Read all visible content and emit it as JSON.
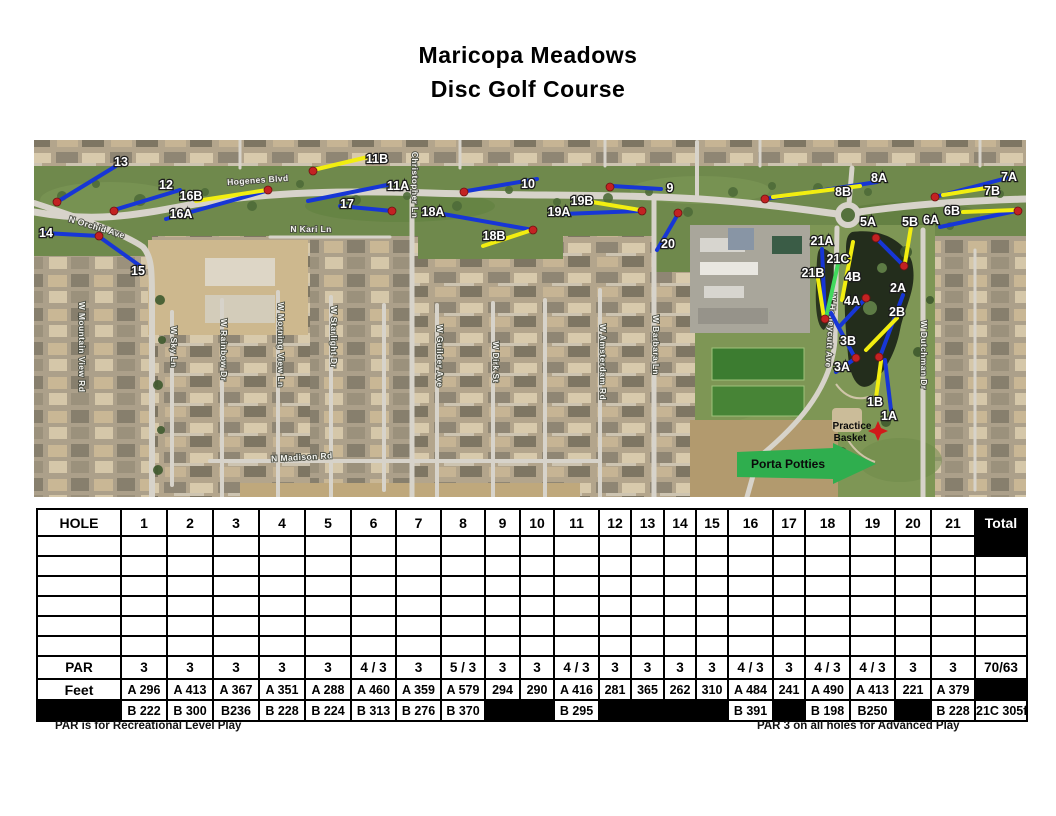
{
  "title": {
    "line1": "Maricopa Meadows",
    "line2": "Disc Golf Course"
  },
  "map": {
    "colors": {
      "tee_a": "#1736d6",
      "tee_b": "#f2ee10",
      "tee_c": "#41d95c",
      "basket": "#c32222",
      "hole_label": "#ffffff",
      "street_label": "#f4f4f0"
    },
    "streets": [
      {
        "label": "Hogenes Blvd",
        "x": 258,
        "y": 183,
        "rot": -4
      },
      {
        "label": "N Orchid Ave",
        "x": 96,
        "y": 230,
        "rot": 17
      },
      {
        "label": "N Kari Ln",
        "x": 311,
        "y": 232,
        "rot": 0
      },
      {
        "label": "Christopher Ln",
        "x": 412,
        "y": 185,
        "rot": 90
      },
      {
        "label": "W Mountain View Rd",
        "x": 79,
        "y": 347,
        "rot": 90
      },
      {
        "label": "W Sky Ln",
        "x": 171,
        "y": 347,
        "rot": 90
      },
      {
        "label": "W Rainbow Dr",
        "x": 221,
        "y": 350,
        "rot": 90
      },
      {
        "label": "W Morning View Ln",
        "x": 278,
        "y": 345,
        "rot": 90
      },
      {
        "label": "W Starlight Dr",
        "x": 331,
        "y": 337,
        "rot": 90
      },
      {
        "label": "W Guilder Ave",
        "x": 437,
        "y": 356,
        "rot": 90
      },
      {
        "label": "W Dirk St",
        "x": 493,
        "y": 362,
        "rot": 90
      },
      {
        "label": "W Amsterdam Rd",
        "x": 600,
        "y": 362,
        "rot": 90
      },
      {
        "label": "W Barbara Ln",
        "x": 653,
        "y": 345,
        "rot": 90
      },
      {
        "label": "N Madison Rd",
        "x": 302,
        "y": 460,
        "rot": -3
      },
      {
        "label": "W Honeycutt Ave",
        "x": 828,
        "y": 330,
        "rot": 94
      },
      {
        "label": "W Dutchman Dr",
        "x": 921,
        "y": 355,
        "rot": 90
      }
    ],
    "hole_markers": [
      {
        "label": "14",
        "x": 46,
        "y": 233
      },
      {
        "label": "13",
        "x": 121,
        "y": 162
      },
      {
        "label": "12",
        "x": 166,
        "y": 185
      },
      {
        "label": "16B",
        "x": 191,
        "y": 196
      },
      {
        "label": "16A",
        "x": 181,
        "y": 214
      },
      {
        "label": "15",
        "x": 138,
        "y": 271
      },
      {
        "label": "11B",
        "x": 377,
        "y": 159
      },
      {
        "label": "11A",
        "x": 398,
        "y": 186
      },
      {
        "label": "17",
        "x": 347,
        "y": 204
      },
      {
        "label": "18A",
        "x": 433,
        "y": 212
      },
      {
        "label": "18B",
        "x": 494,
        "y": 236
      },
      {
        "label": "10",
        "x": 528,
        "y": 184
      },
      {
        "label": "19A",
        "x": 559,
        "y": 212
      },
      {
        "label": "19B",
        "x": 582,
        "y": 201
      },
      {
        "label": "9",
        "x": 670,
        "y": 188
      },
      {
        "label": "20",
        "x": 668,
        "y": 244
      },
      {
        "label": "8A",
        "x": 879,
        "y": 178
      },
      {
        "label": "8B",
        "x": 843,
        "y": 192
      },
      {
        "label": "7A",
        "x": 1009,
        "y": 177
      },
      {
        "label": "7B",
        "x": 992,
        "y": 191
      },
      {
        "label": "6B",
        "x": 952,
        "y": 211
      },
      {
        "label": "6A",
        "x": 931,
        "y": 220
      },
      {
        "label": "5A",
        "x": 868,
        "y": 222
      },
      {
        "label": "5B",
        "x": 910,
        "y": 222
      },
      {
        "label": "21A",
        "x": 822,
        "y": 241
      },
      {
        "label": "21C",
        "x": 838,
        "y": 259
      },
      {
        "label": "21B",
        "x": 813,
        "y": 273
      },
      {
        "label": "4B",
        "x": 853,
        "y": 277
      },
      {
        "label": "4A",
        "x": 852,
        "y": 301
      },
      {
        "label": "2A",
        "x": 898,
        "y": 288
      },
      {
        "label": "2B",
        "x": 897,
        "y": 312
      },
      {
        "label": "3B",
        "x": 848,
        "y": 341
      },
      {
        "label": "3A",
        "x": 842,
        "y": 367
      },
      {
        "label": "1B",
        "x": 875,
        "y": 402
      },
      {
        "label": "1A",
        "x": 889,
        "y": 416
      }
    ],
    "hole_lines": [
      {
        "hole": "13",
        "tee": "A",
        "x1": 57,
        "y1": 202,
        "x2": 116,
        "y2": 166
      },
      {
        "hole": "12",
        "tee": "A",
        "x1": 114,
        "y1": 210,
        "x2": 180,
        "y2": 190
      },
      {
        "hole": "14",
        "tee": "A",
        "x1": 44,
        "y1": 233,
        "x2": 99,
        "y2": 236
      },
      {
        "hole": "15",
        "tee": "A",
        "x1": 101,
        "y1": 238,
        "x2": 143,
        "y2": 268
      },
      {
        "hole": "16A",
        "tee": "A",
        "x1": 166,
        "y1": 219,
        "x2": 266,
        "y2": 191
      },
      {
        "hole": "16B",
        "tee": "B",
        "x1": 196,
        "y1": 201,
        "x2": 267,
        "y2": 190
      },
      {
        "hole": "17",
        "tee": "A",
        "x1": 340,
        "y1": 206,
        "x2": 392,
        "y2": 211
      },
      {
        "hole": "11A",
        "tee": "A",
        "x1": 308,
        "y1": 201,
        "x2": 392,
        "y2": 184
      },
      {
        "hole": "11B",
        "tee": "B",
        "x1": 313,
        "y1": 170,
        "x2": 368,
        "y2": 157
      },
      {
        "hole": "10",
        "tee": "A",
        "x1": 467,
        "y1": 191,
        "x2": 537,
        "y2": 179
      },
      {
        "hole": "18A",
        "tee": "A",
        "x1": 443,
        "y1": 214,
        "x2": 533,
        "y2": 230
      },
      {
        "hole": "18B",
        "tee": "B",
        "x1": 483,
        "y1": 246,
        "x2": 532,
        "y2": 230
      },
      {
        "hole": "19A",
        "tee": "A",
        "x1": 563,
        "y1": 214,
        "x2": 638,
        "y2": 211
      },
      {
        "hole": "19B",
        "tee": "B",
        "x1": 592,
        "y1": 202,
        "x2": 640,
        "y2": 210
      },
      {
        "hole": "9",
        "tee": "A",
        "x1": 612,
        "y1": 186,
        "x2": 661,
        "y2": 189
      },
      {
        "hole": "20",
        "tee": "A",
        "x1": 678,
        "y1": 214,
        "x2": 657,
        "y2": 250
      },
      {
        "hole": "8A",
        "tee": "A",
        "x1": 765,
        "y1": 199,
        "x2": 877,
        "y2": 182
      },
      {
        "hole": "8B",
        "tee": "B",
        "x1": 773,
        "y1": 197,
        "x2": 860,
        "y2": 186
      },
      {
        "hole": "7A",
        "tee": "A",
        "x1": 935,
        "y1": 197,
        "x2": 1007,
        "y2": 178
      },
      {
        "hole": "7B",
        "tee": "B",
        "x1": 943,
        "y1": 195,
        "x2": 986,
        "y2": 188
      },
      {
        "hole": "6A",
        "tee": "A",
        "x1": 940,
        "y1": 227,
        "x2": 1016,
        "y2": 211
      },
      {
        "hole": "6B",
        "tee": "B",
        "x1": 963,
        "y1": 212,
        "x2": 1016,
        "y2": 210
      },
      {
        "hole": "5A",
        "tee": "A",
        "x1": 876,
        "y1": 238,
        "x2": 904,
        "y2": 266
      },
      {
        "hole": "5B",
        "tee": "B",
        "x1": 911,
        "y1": 227,
        "x2": 905,
        "y2": 263
      },
      {
        "hole": "21A",
        "tee": "A",
        "x1": 822,
        "y1": 249,
        "x2": 825,
        "y2": 318
      },
      {
        "hole": "21B",
        "tee": "B",
        "x1": 818,
        "y1": 279,
        "x2": 824,
        "y2": 318
      },
      {
        "hole": "21C",
        "tee": "C",
        "x1": 838,
        "y1": 264,
        "x2": 826,
        "y2": 318
      },
      {
        "hole": "4A",
        "tee": "A",
        "x1": 866,
        "y1": 298,
        "x2": 840,
        "y2": 326
      },
      {
        "hole": "4B",
        "tee": "B",
        "x1": 853,
        "y1": 242,
        "x2": 842,
        "y2": 300
      },
      {
        "hole": "2A",
        "tee": "A",
        "x1": 903,
        "y1": 295,
        "x2": 881,
        "y2": 354
      },
      {
        "hole": "2B",
        "tee": "B",
        "x1": 897,
        "y1": 318,
        "x2": 866,
        "y2": 350
      },
      {
        "hole": "3B",
        "tee": "A",
        "x1": 831,
        "y1": 313,
        "x2": 854,
        "y2": 356
      },
      {
        "hole": "3A",
        "tee": "A",
        "x1": 856,
        "y1": 358,
        "x2": 836,
        "y2": 372
      },
      {
        "hole": "1A",
        "tee": "A",
        "x1": 891,
        "y1": 410,
        "x2": 885,
        "y2": 360
      },
      {
        "hole": "1B",
        "tee": "B",
        "x1": 876,
        "y1": 398,
        "x2": 881,
        "y2": 361
      }
    ],
    "baskets": [
      [
        57,
        202
      ],
      [
        114,
        211
      ],
      [
        99,
        236
      ],
      [
        268,
        190
      ],
      [
        313,
        171
      ],
      [
        392,
        211
      ],
      [
        464,
        192
      ],
      [
        533,
        230
      ],
      [
        610,
        187
      ],
      [
        642,
        211
      ],
      [
        678,
        213
      ],
      [
        765,
        199
      ],
      [
        935,
        197
      ],
      [
        1018,
        211
      ],
      [
        876,
        238
      ],
      [
        904,
        266
      ],
      [
        825,
        319
      ],
      [
        866,
        298
      ],
      [
        856,
        358
      ],
      [
        879,
        357
      ]
    ],
    "practice_basket": {
      "label_line1": "Practice",
      "label_line2": "Basket",
      "x": 878,
      "y": 431
    },
    "porta_potties": {
      "label": "Porta Potties",
      "x": 788,
      "y": 468
    }
  },
  "scorecard": {
    "header": [
      "HOLE",
      "1",
      "2",
      "3",
      "4",
      "5",
      "6",
      "7",
      "8",
      "9",
      "10",
      "11",
      "12",
      "13",
      "14",
      "15",
      "16",
      "17",
      "18",
      "19",
      "20",
      "21",
      "Total"
    ],
    "col_widths": [
      84,
      46,
      46,
      46,
      46,
      46,
      45,
      45,
      44,
      35,
      34,
      45,
      32,
      33,
      32,
      32,
      45,
      32,
      45,
      45,
      36,
      44,
      52
    ],
    "empty_row_count": 6,
    "par": {
      "label": "PAR",
      "values": [
        "3",
        "3",
        "3",
        "3",
        "3",
        "4 / 3",
        "3",
        "5 / 3",
        "3",
        "3",
        "4 / 3",
        "3",
        "3",
        "3",
        "3",
        "4 / 3",
        "3",
        "4 / 3",
        "4 / 3",
        "3",
        "3"
      ],
      "total": "70/63"
    },
    "feet": {
      "label": "Feet",
      "values": [
        "A 296",
        "A 413",
        "A 367",
        "A 351",
        "A 288",
        "A 460",
        "A 359",
        "A 579",
        "294",
        "290",
        "A 416",
        "281",
        "365",
        "262",
        "310",
        "A 484",
        "241",
        "A 490",
        "A 413",
        "221",
        "A 379"
      ],
      "total": null
    },
    "b_row": {
      "values": [
        "B 222",
        "B 300",
        "B236",
        "B 228",
        "B 224",
        "B 313",
        "B 276",
        "B 370",
        null,
        null,
        "B 295",
        null,
        null,
        null,
        null,
        "B 391",
        null,
        "B 198",
        "B250",
        null,
        "B 228"
      ],
      "total": "21C 305ft"
    }
  },
  "footnotes": {
    "left": "PAR is for Recreational Level Play",
    "right": "PAR 3 on all holes for Advanced Play"
  }
}
